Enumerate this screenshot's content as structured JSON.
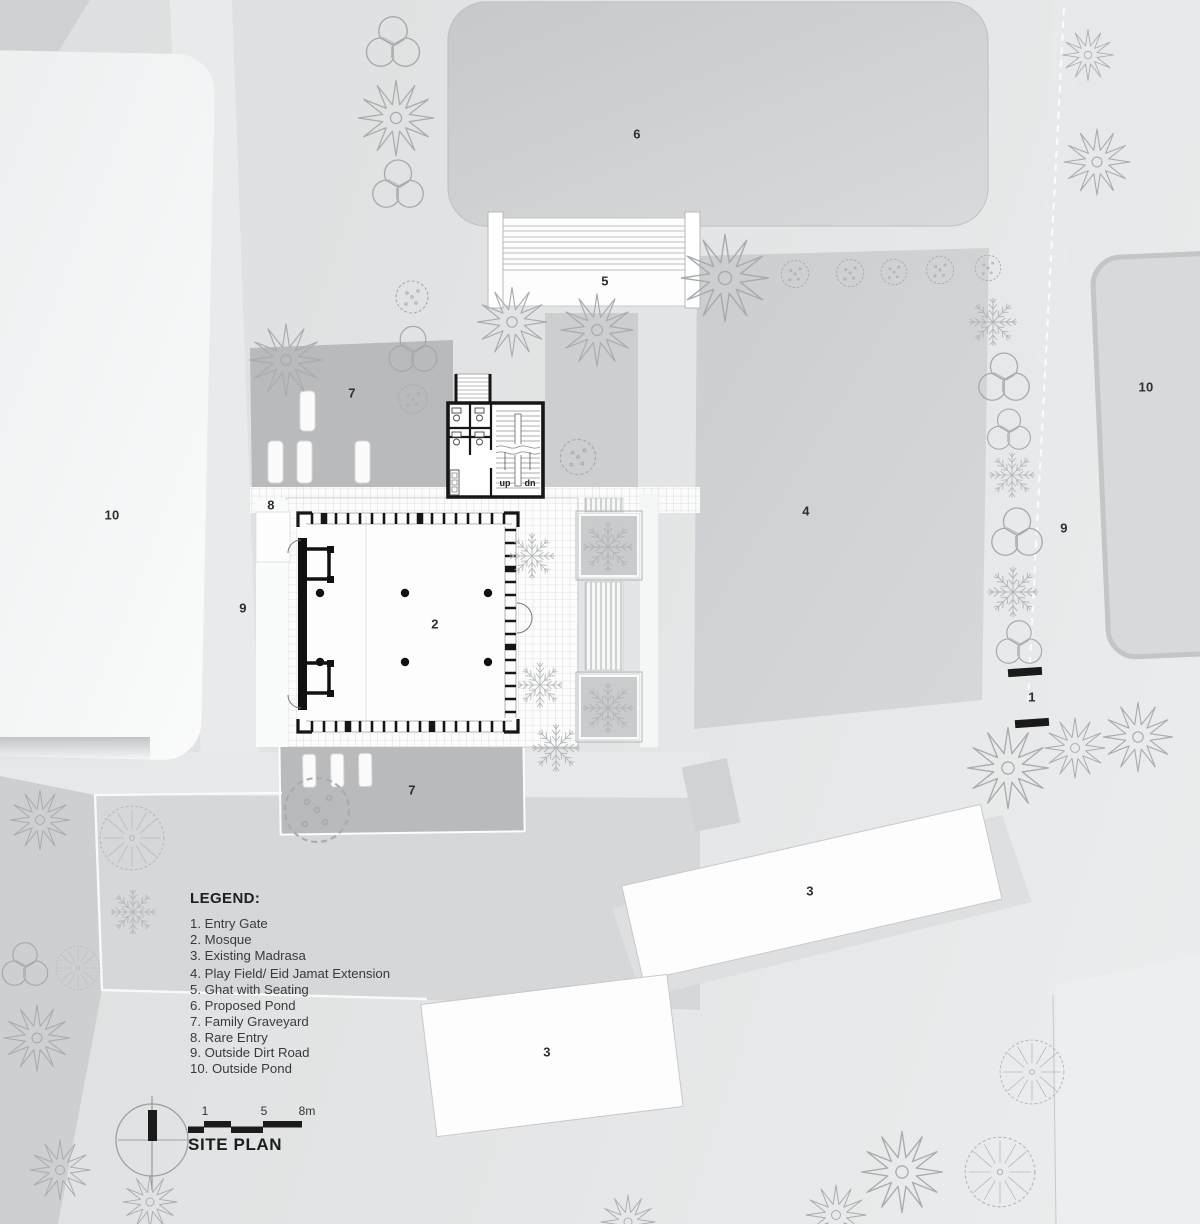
{
  "page": {
    "title": "Mosque Complex Site Plan"
  },
  "legend": {
    "title": "LEGEND:",
    "items": [
      "1. Entry Gate",
      "2. Mosque",
      "3. Existing Madrasa",
      "4. Play Field/ Eid Jamat Extension",
      "5. Ghat with Seating",
      "6. Proposed Pond",
      "7. Family Graveyard",
      "8. Rare Entry",
      "9. Outside Dirt Road",
      "10. Outside Pond"
    ]
  },
  "scale_bar": {
    "ticks": [
      "1",
      "5",
      "8m"
    ],
    "drawing_title": "SITE PLAN"
  },
  "plan_labels": [
    {
      "name": "proposed-pond",
      "text": "6"
    },
    {
      "name": "ghat-with-seating",
      "text": "5"
    },
    {
      "name": "outside-pond-right",
      "text": "10"
    },
    {
      "name": "family-graveyard-north",
      "text": "7"
    },
    {
      "name": "play-field",
      "text": "4"
    },
    {
      "name": "rare-entry",
      "text": "8"
    },
    {
      "name": "outside-pond-left",
      "text": "10"
    },
    {
      "name": "outside-dirt-road-right",
      "text": "9"
    },
    {
      "name": "mosque",
      "text": "2"
    },
    {
      "name": "outside-dirt-road-left",
      "text": "9"
    },
    {
      "name": "entry-gate",
      "text": "1"
    },
    {
      "name": "family-graveyard-south",
      "text": "7"
    },
    {
      "name": "existing-madrasa-upper",
      "text": "3"
    },
    {
      "name": "existing-madrasa-lower",
      "text": "3"
    }
  ],
  "stair": {
    "up": "up",
    "dn": "dn"
  },
  "colors": {
    "background": "#e2e4e5",
    "parcel_gray": "#d5d7d8",
    "graveyard_gray": "#b8babc",
    "pond_gray": "#d2d4d6",
    "building_white": "#fdfdfd",
    "line_black": "#1b1b1b",
    "tree_outline": "#a9acae"
  }
}
